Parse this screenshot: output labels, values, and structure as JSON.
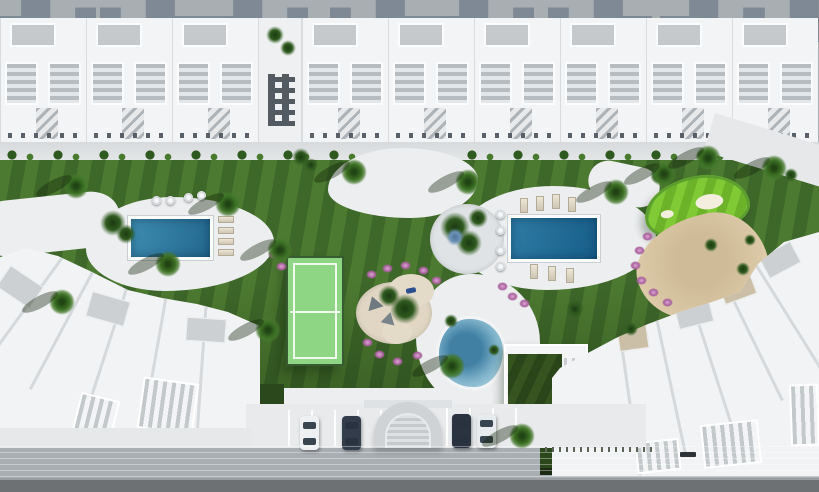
{
  "meta": {
    "type": "architectural-aerial-render",
    "description": "Top-down 3D rendering of a white Mediterranean residential community with amenity gardens",
    "contains_text": false
  },
  "palette": {
    "back_pavement": "#a9aeb3",
    "building_shadow": "#7e8995",
    "building_white": "#f2f4f5",
    "roof_panel_gray": "#c5c9cc",
    "lawn_light": "#4d7a31",
    "lawn_dark": "#3e672a",
    "lawn_deep": "#2b481c",
    "path_white": "#eceeef",
    "pool_left_blue": "#2f7fa6",
    "pool_right_blue": "#1f6b97",
    "lagoon_blue": "#7fb3ca",
    "padel_court_green": "#8ed584",
    "putting_green": "#79c22f",
    "sand_beige": "#dbc8a6",
    "flower_pink": "#a8609c",
    "road_dark": "#6e7174",
    "walkway_gray": "#cbced0"
  },
  "scene": {
    "areas": [
      {
        "name": "townhouse-row",
        "description": "Row of white townhouses with pergola roofs along the top, casting shadows onto rear pavement"
      },
      {
        "name": "entrance-tower",
        "description": "Taller white block with small dark windows and palm courtyard"
      },
      {
        "name": "striped-lawn",
        "description": "Large mowed lawn with diagonal stripes and meandering white paths"
      },
      {
        "name": "lap-pool-west",
        "description": "Rectangular blue pool with loungers and round poufs"
      },
      {
        "name": "lap-pool-east",
        "description": "Rectangular deep-blue pool with lounger rows on both sides"
      },
      {
        "name": "padel-court",
        "description": "Fenced light-green padel/tennis court with white lines"
      },
      {
        "name": "kids-playground",
        "description": "Sand circles with teepee hammock structures ringed by pink flowers"
      },
      {
        "name": "lagoon-pool",
        "description": "Free-form lagoon pool beside clubhouse"
      },
      {
        "name": "green-roof-clubhouse",
        "description": "Building with planted green roof and slatted pergola"
      },
      {
        "name": "putting-green",
        "description": "Bright mini-golf green with white sand bunkers"
      },
      {
        "name": "beach-sand-area",
        "description": "Beige sand lounge area bordered by flowers"
      },
      {
        "name": "southwest-building",
        "description": "Fan-shaped white apartment cluster with thatch umbrellas"
      },
      {
        "name": "southeast-building",
        "description": "Angled white apartment cluster"
      },
      {
        "name": "entrance-arch",
        "description": "Arched gateway with steps between parking bays"
      },
      {
        "name": "street",
        "description": "Sidewalk and dark asphalt road along the bottom"
      }
    ],
    "vehicles": [
      {
        "name": "car",
        "color": "#eef0f2"
      },
      {
        "name": "car",
        "color": "#333c4b"
      },
      {
        "name": "car",
        "color": "#2b3340"
      },
      {
        "name": "car",
        "color": "#e8ebee"
      }
    ],
    "counts": {
      "townhouse_units": 9,
      "rect_pools": 2,
      "parked_cars": 4,
      "thatch_umbrellas": 2
    }
  }
}
